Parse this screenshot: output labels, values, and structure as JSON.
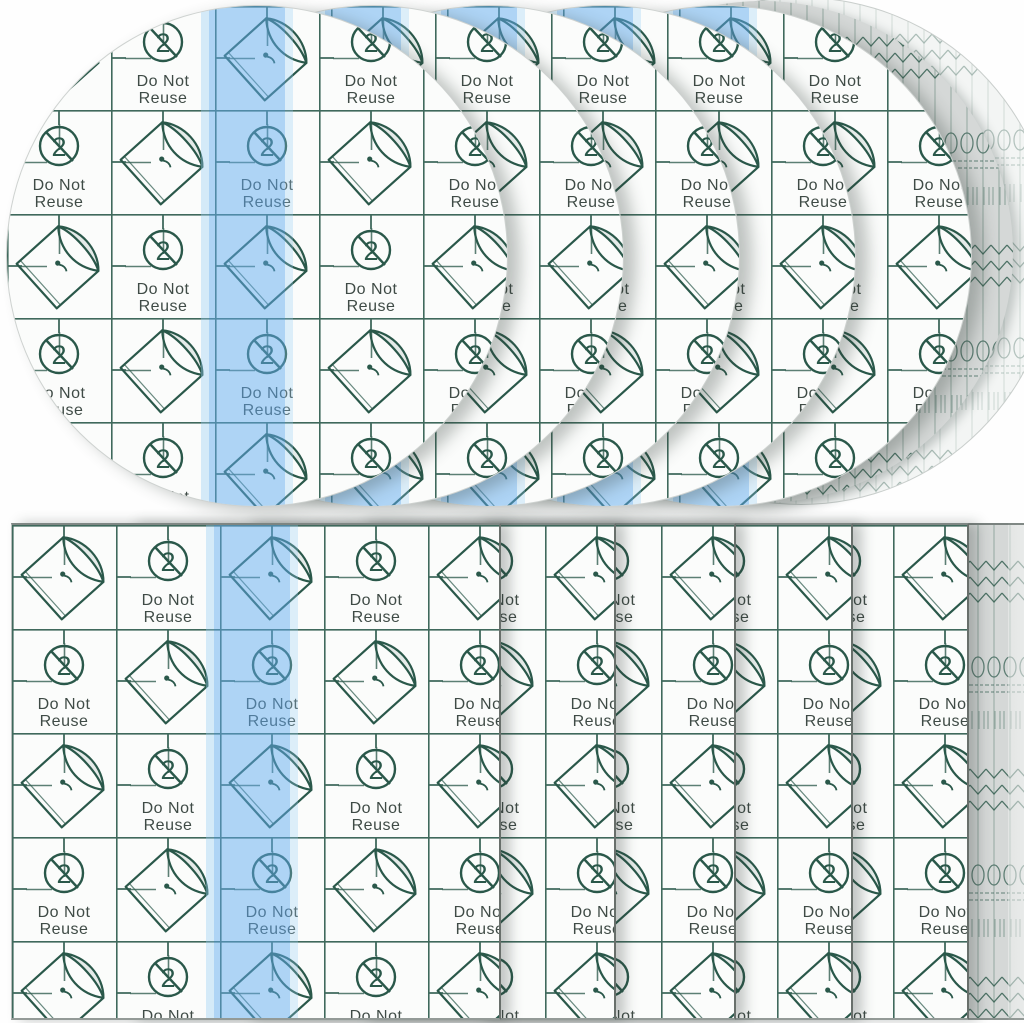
{
  "pattern": {
    "do_not_label": "Do Not",
    "reuse_label": "Reuse",
    "reuse_symbol_numeral": "2"
  },
  "colors": {
    "print_green": "#2a584a",
    "text_green": "#3f4b46",
    "liner_stripe_blue": "#61acf0",
    "stack_gray": "#d5d8d7",
    "backing_white": "#fbfcfb"
  },
  "scene": {
    "top_row_round_patches": 5,
    "bottom_rectangular_sheets": 5,
    "description_top": "round transparent film patches fanned left to right",
    "description_bottom": "rectangular transparent film sheets fanned left to right"
  }
}
